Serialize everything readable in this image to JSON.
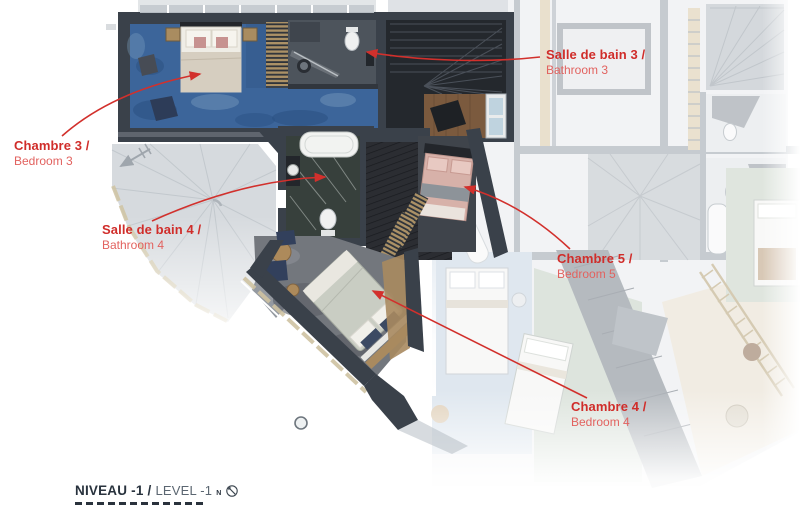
{
  "plan": {
    "labels": {
      "chambre3": {
        "title": "Chambre 3 /",
        "subtitle": "Bedroom 3"
      },
      "bathroom3": {
        "title": "Salle de bain 3 /",
        "subtitle": "Bathroom 3"
      },
      "bathroom4": {
        "title": "Salle de bain 4 /",
        "subtitle": "Bathroom 4"
      },
      "chambre5": {
        "title": "Chambre 5 /",
        "subtitle": "Bedroom 5"
      },
      "chambre4": {
        "title": "Chambre 4 /",
        "subtitle": "Bedroom 4"
      }
    },
    "footer": {
      "level_fr": "NIVEAU -1 /",
      "level_en": "LEVEL -1",
      "north_label": "N"
    },
    "colors": {
      "annotation_red": "#d02d2a",
      "annotation_red_light": "#e2625f",
      "arrow_red": "#d2302c",
      "footer_dark": "#28323d",
      "footer_gray": "#5b6671",
      "wall_dark": "#3a414a",
      "carpet_blue": "#3c659a",
      "carpet_gray": "#73777d",
      "bed_pink": "#d7b1a9"
    }
  }
}
